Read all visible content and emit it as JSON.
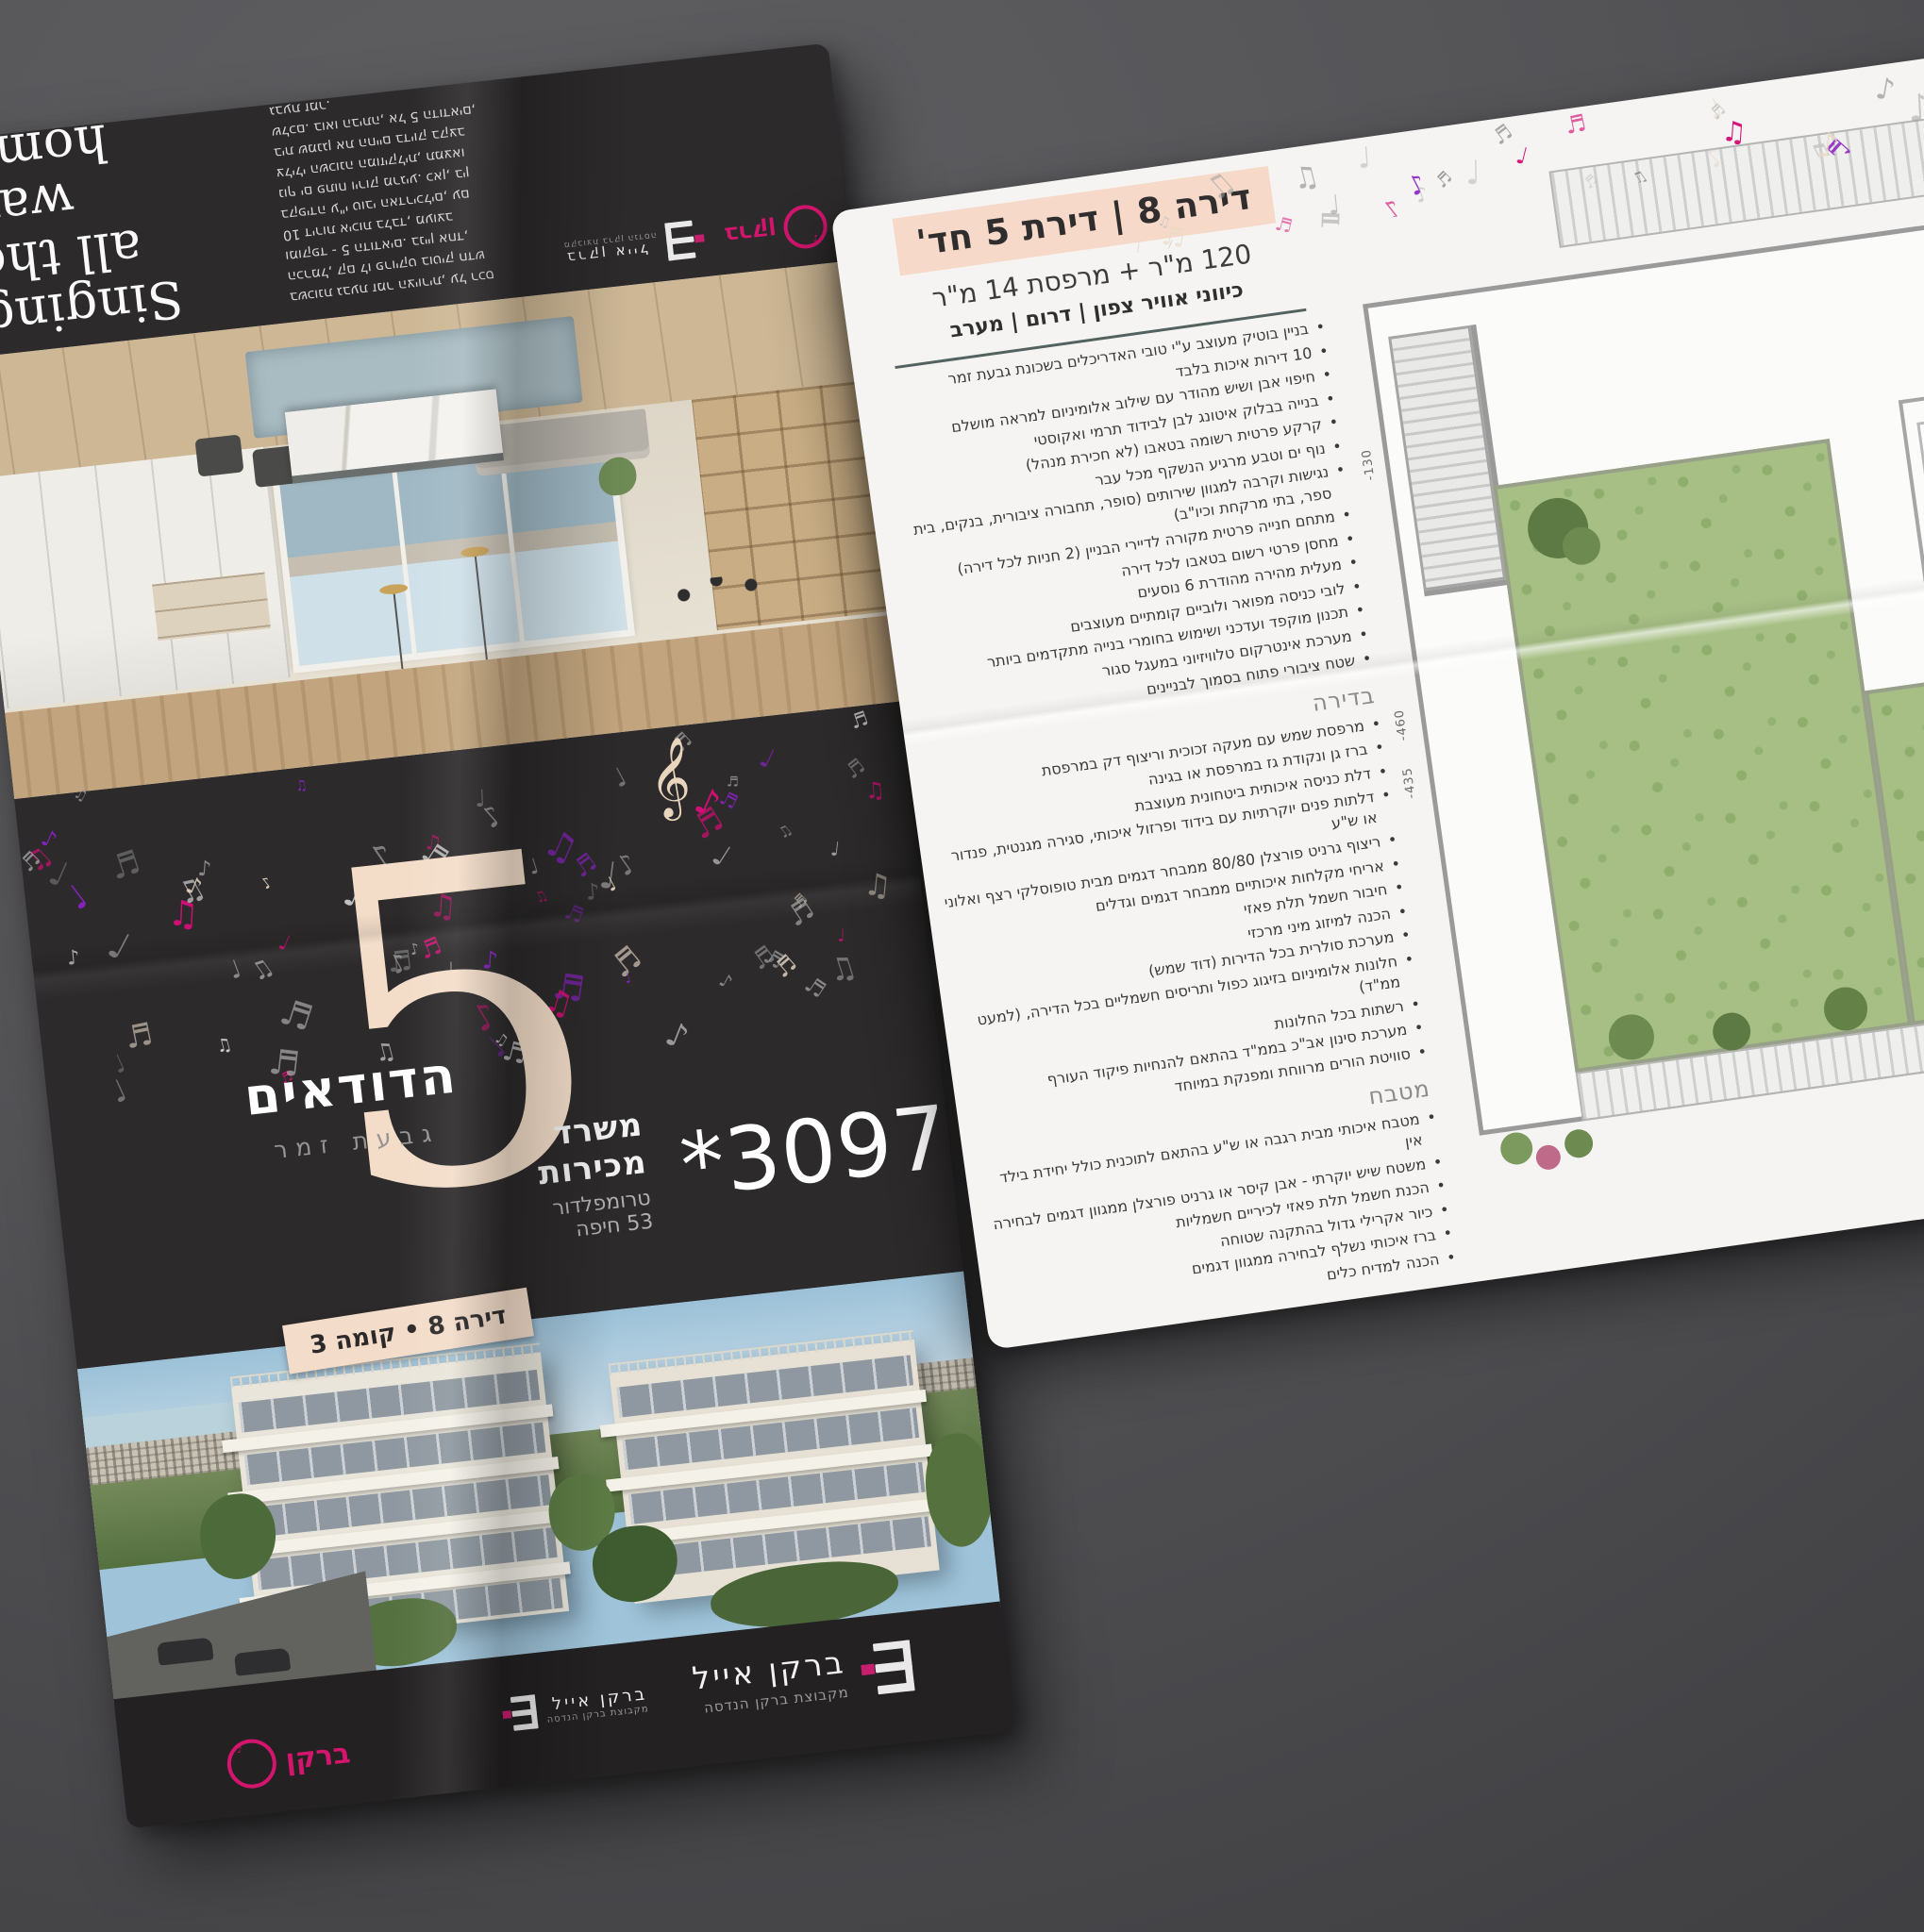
{
  "left_page": {
    "headline": "Singing\nall the\nway\nhome",
    "intro_paragraph": "בשכונת גבעת זמר הציורית, על רכס\nהכרמל, קם לו פרויקט בוטיק חדש\nומוקפד - 5 הדודאים. בניין אחד,\n10 דירות איכות בלבד, מעוצב\nבקפידה ע\"י טובי האדריכלים, עם\nנוף ים פתוח וירוק מרגיע. כאן, בין\nצלילי השכונה המוזיקלית, תמצאו\nבית שמנגן את החיים בדיוק בקצב\nשלכם. בואו הביתה, אל 5 הדודאים,\nגבעת זמר."
  },
  "project": {
    "number": "5",
    "name": "הדודאים",
    "location": "גבעת זמר",
    "unit_badge": "דירה 8 • קומה 3"
  },
  "contact": {
    "phone": "*3097",
    "office_line1": "משרד מכירות",
    "office_line2": "טרומפלדור 53 חיפה"
  },
  "brand": {
    "name": "ברקן אייל",
    "sub": "מקבוצת ברקן הנדסה",
    "short": "ברקן"
  },
  "right_page": {
    "title": "דירה 8 | דירת 5 חד'",
    "subtitle": "120 מ\"ר + מרפסת 14 מ\"ר",
    "directions": "כיווני אוויר צפון | דרום | מערב",
    "sections": [
      {
        "header": "",
        "items": [
          "בניין בוטיק מעוצב ע\"י טובי האדריכלים בשכונת גבעת זמר",
          "10 דירות איכות בלבד",
          "חיפוי אבן ושיש מהודר עם שילוב אלומיניום למראה מושלם",
          "בנייה בבלוק איטונג לבן לבידוד תרמי ואקוסטי",
          "קרקע פרטית רשומה בטאבו (לא חכירת מנהל)",
          "נוף ים וטבע מרגיע הנשקף מכל עבר",
          "נגישות וקרבה למגוון שירותים (סופר, תחבורה ציבורית, בנקים, בית ספר, בתי מרקחת וכיו\"ב)",
          "מתחם חנייה פרטית מקורה לדיירי הבניין (2 חניות לכל דירה)",
          "מחסן פרטי רשום בטאבו לכל דירה",
          "מעלית מהירה מהודרת 6 נוסעים",
          "לובי כניסה מפואר ולוביים קומתיים מעוצבים",
          "תכנון מוקפד ועדכני ושימוש בחומרי בנייה מתקדמים ביותר",
          "מערכת אינטרקום טלוויזיוני במעגל סגור",
          "שטח ציבורי פתוח בסמוך לבניינים"
        ]
      },
      {
        "header": "בדירה",
        "items": [
          "מרפסת שמש עם מעקה זכוכית וריצוף דק במרפסת",
          "ברז גן ונקודת גז במרפסת או בגינה",
          "דלת כניסה איכותית ביטחונית מעוצבת",
          "דלתות פנים יוקרתיות עם בידוד ופרזול איכותי, סגירה מגנטית, פנדור או ש\"ע",
          "ריצוף גרניט פורצלן 80/80 ממבחר דגמים מבית טופוסלקי רצף ואלוני",
          "אריחי מקלחות איכותיים ממבחר דגמים וגדלים",
          "חיבור חשמל תלת פאזי",
          "הכנה למיזוג מיני מרכזי",
          "מערכת סולרית בכל הדירות (דוד שמש)",
          "חלונות אלומיניום בזיגוג כפול ותריסים חשמליים בכל הדירה, (למעט ממ\"ד)",
          "רשתות בכל החלונות",
          "מערכת סינון אב\"כ בממ\"ד בהתאם להנחיות פיקוד העורף",
          "סוויטת הורים מרווחת ומפנקת במיוחד"
        ]
      },
      {
        "header": "מטבח",
        "items": [
          "מטבח איכותי מבית רגבה או ש\"ע בהתאם לתוכנית כולל יחידת בילד אין",
          "משטח שיש יוקרתי - אבן קיסר או גרניט פורצלן ממגוון דגמים לבחירה",
          "הכנת חשמל תלת פאזי לכיריים חשמליות",
          "כיור אקרילי גדול בהתקנה שטוחה",
          "ברז איכותי נשלף לבחירה ממגוון דגמים",
          "הכנה למדיח כלים"
        ]
      },
      {
        "header": "חדרי רחצה",
        "items": [
          "אמבטיה אקרילית איכותית",
          "אסלות תלויות ומכלי הדחה סמויים",
          "ארון מקלחת איכותי + כיור + מראה",
          "ברזי פרח איכותיים מסדרות יוקרה לבחירה ממגוון דגמים",
          "מבחר חיפויי קירות למקלחות במגוון גדלים"
        ]
      }
    ],
    "floorplan": {
      "measurements": [
        "-130",
        "-460",
        "-435"
      ]
    }
  },
  "decor": {
    "note_glyphs": [
      "♪",
      "♫",
      "♬",
      "♩"
    ],
    "treble_clef": "𝄞",
    "note_colors": [
      "#9b9b9b",
      "#777777",
      "#c6c6c6",
      "#d40f76",
      "#8b22c4",
      "#e9d9c6",
      "#b3b3b3"
    ],
    "accent_peach": "#f6d9c8",
    "cream": "#f3dcc9",
    "magenta": "#d40f76",
    "purple": "#8b22c4",
    "brand_pink": "#d4156e",
    "plan_green": "#a7bf85",
    "dark_bg": "#2c2a2b"
  }
}
